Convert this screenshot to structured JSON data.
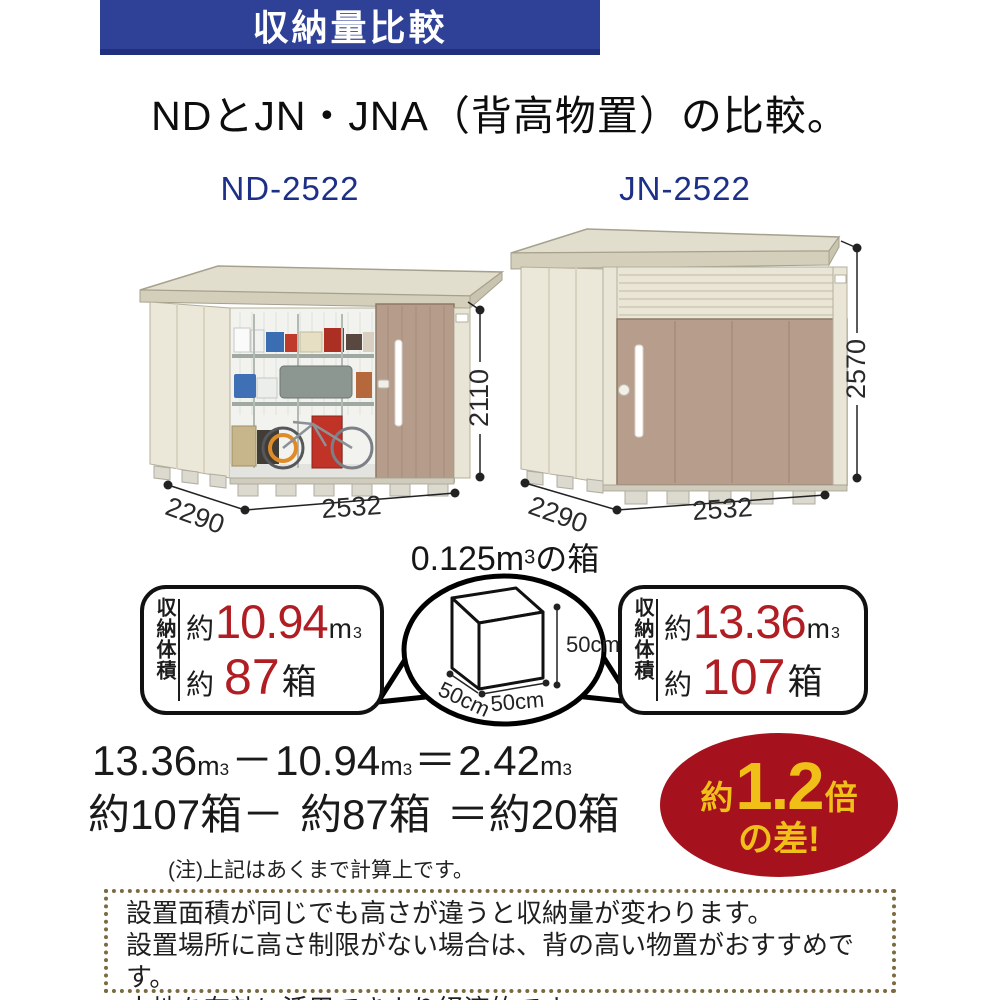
{
  "banner": {
    "title": "収納量比較",
    "bg": "#2e4197",
    "accent_dark": "#20307c"
  },
  "heading": {
    "text": "NDとJN・JNA（背高物置）の比較。"
  },
  "sheds": {
    "left": {
      "model": "ND-2522",
      "width_label": "2532",
      "depth_label": "2290",
      "height_label": "2110"
    },
    "right": {
      "model": "JN-2522",
      "width_label": "2532",
      "depth_label": "2290",
      "height_label": "2570"
    }
  },
  "cube": {
    "prefix": "0.125m",
    "sup": "3",
    "suffix": "の箱",
    "edge": "50cm"
  },
  "stats": {
    "left": {
      "label_vertical": "収納体積",
      "approx": "約",
      "volume": "10.94",
      "unit": "m",
      "unit_sup": "3",
      "boxes": "87",
      "boxes_unit": "箱"
    },
    "right": {
      "label_vertical": "収納体積",
      "approx": "約",
      "volume": "13.36",
      "unit": "m",
      "unit_sup": "3",
      "boxes": "107",
      "boxes_unit": "箱"
    }
  },
  "calc": {
    "line1": {
      "v1": "13.36",
      "minus": "－",
      "v2": "10.94",
      "eq": "＝",
      "v3": "2.42",
      "unit": "m",
      "unit_sup": "3"
    },
    "line2": {
      "s1": "約107箱－",
      "s2": "約87箱",
      "s3": "＝約20箱"
    },
    "note": "(注)上記はあくまで計算上です。"
  },
  "badge": {
    "approx": "約",
    "value": "1.2",
    "times": "倍",
    "line2": "の差!",
    "bg": "#a5121e",
    "fg": "#f0c019"
  },
  "footer": {
    "lines": [
      "設置面積が同じでも高さが違うと収納量が変わります。",
      "設置場所に高さ制限がない場合は、背の高い物置がおすすめです。",
      "土地を有効に活用できより経済的です。"
    ]
  },
  "colors": {
    "wall_cream": "#ece8d9",
    "roof": "#e2decd",
    "door_tan": "#b79d8b",
    "red_number": "#b01e23",
    "label_navy": "#1c3087",
    "footer_border": "#7c6b40"
  }
}
